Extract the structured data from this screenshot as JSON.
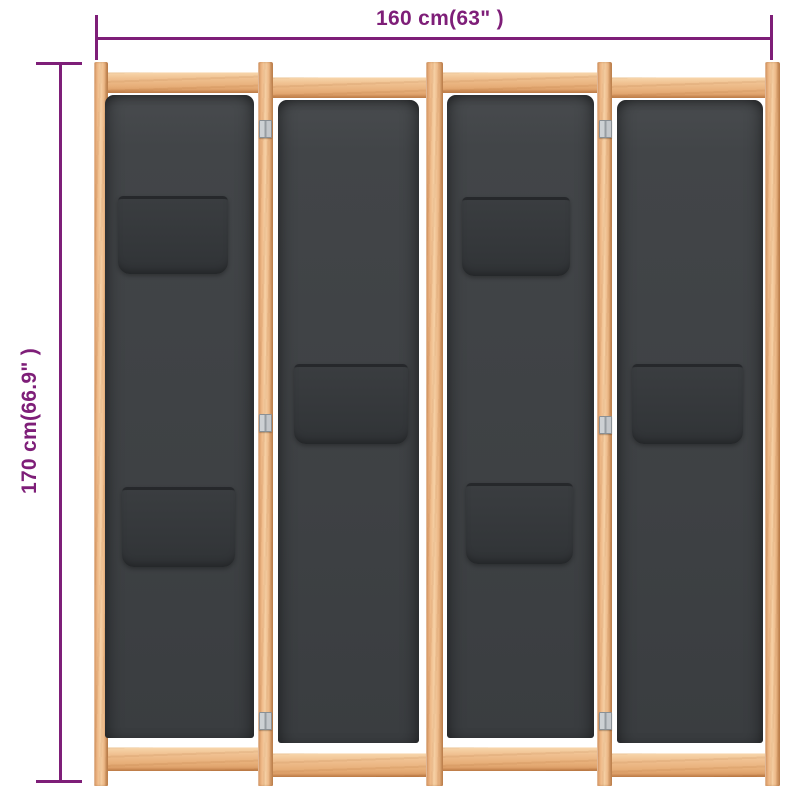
{
  "image": {
    "type": "product dimension diagram",
    "background": "#ffffff"
  },
  "dimensions": {
    "width_label": "160 cm(63\" )",
    "height_label": "170 cm(66.9\" )",
    "annotation_color": "#7e1e78"
  },
  "product": {
    "description": "4-panel folding room divider with light wooden frame, dark grey fabric panels, patch pockets and metal hinges",
    "panel_count": 4,
    "visible_hinge_count": 6,
    "panels": [
      {
        "position": 1,
        "pockets": 2
      },
      {
        "position": 2,
        "pockets": 1
      },
      {
        "position": 3,
        "pockets": 2
      },
      {
        "position": 4,
        "pockets": 1
      }
    ],
    "colors": {
      "wood": "#eeb887",
      "fabric": "#3e4144",
      "pocket": "#34383b",
      "hinge": "#c0c4c8"
    }
  }
}
